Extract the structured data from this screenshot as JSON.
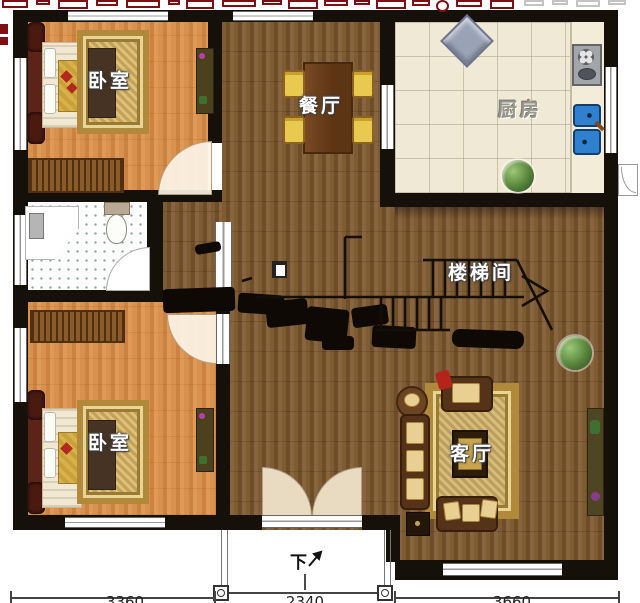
{
  "page": {
    "kind": "residential floor plan, top-down render"
  },
  "palette": {
    "wall": "#16100b",
    "wood_light": "#d8914e",
    "wood_dark": "#7a5832",
    "kitchen_tile": "#efe9d6",
    "rug_gold": "#c9a84c",
    "sink_blue": "#2f7fd0",
    "chair_yellow": "#e9c94f",
    "watermark_red": "#7c1014"
  },
  "rooms": {
    "bedroom_top": {
      "label": "卧室"
    },
    "dining": {
      "label": "餐厅"
    },
    "kitchen": {
      "label": "厨房"
    },
    "stairwell": {
      "label": "楼梯间"
    },
    "bedroom_bottom": {
      "label": "卧室"
    },
    "living": {
      "label": "客厅"
    }
  },
  "annotations": {
    "entry_direction": "下",
    "dimensions": {
      "left": "3360",
      "center": "2340",
      "right": "3660"
    }
  }
}
